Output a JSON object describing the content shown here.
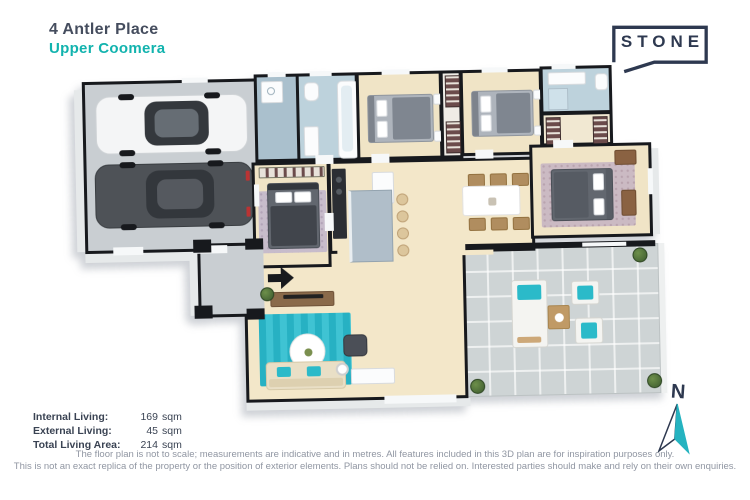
{
  "header": {
    "address": "4 Antler Place",
    "suburb": "Upper Coomera"
  },
  "logo": {
    "text": "STONE"
  },
  "compass": {
    "north_label": "N"
  },
  "areas": {
    "rows": [
      {
        "label": "Internal Living:",
        "num": "169",
        "unit": "sqm"
      },
      {
        "label": "External Living:",
        "num": "45",
        "unit": "sqm"
      },
      {
        "label": "Total Living Area:",
        "num": "214",
        "unit": "sqm"
      }
    ]
  },
  "disclaimer": {
    "line1": "The floor plan is not to scale; measurements are indicative and in metres. All features included in this 3D plan are for inspiration purposes only.",
    "line2": "This is not an exact replica of the property or the position of exterior elements. Plans should not be relied on. Interested parties should make and rely on their own enquiries."
  },
  "colors": {
    "accent_teal": "#12b3ae",
    "navy": "#2e3950",
    "text_dark": "#454d5e",
    "text_gray": "#9096a2",
    "wall": "#17191d",
    "carpet": "#f0e4c6",
    "bathroom_tile": "#bdd2dc",
    "concrete": "#c9ced2",
    "patio_tile": "#ced4d5",
    "rug_teal": "#2bbac9",
    "timber": "#b08d5f"
  }
}
